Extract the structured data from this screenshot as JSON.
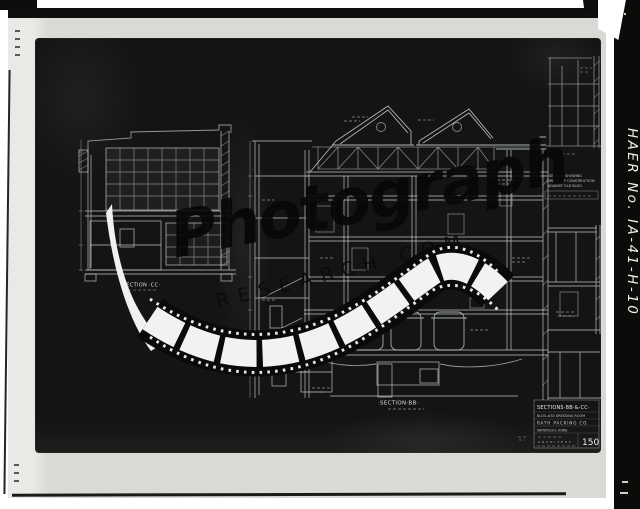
{
  "archive": {
    "haer_label": "HAER No. IA-41-H-10"
  },
  "watermark": {
    "script_text": "Photograph",
    "caps_text": "RESEARCH.COM"
  },
  "drawing": {
    "label_section_cc": "·SECTION ·CC·",
    "label_section_bb": "·SECTION·BB·",
    "note_lines": [
      "SECTION SHOWING",
      "FIREPROOF CONSTRUCTION",
      "AGAINST OLD BLDG."
    ],
    "title_block": {
      "title": "SECTIONS·BB·&·CC·",
      "subtitle": "BLDG.#30 DRESSING ROOM",
      "company": "RATH PACKING CO.",
      "location": "WATERLOO, IOWA.",
      "architect_label": "ARCHITECT",
      "sheet_number": "150"
    }
  },
  "colors": {
    "paper": "#d9d9d6",
    "sheet": "#141414",
    "ink_line": "#c9d2ce",
    "watermark_ink": "#070707"
  }
}
